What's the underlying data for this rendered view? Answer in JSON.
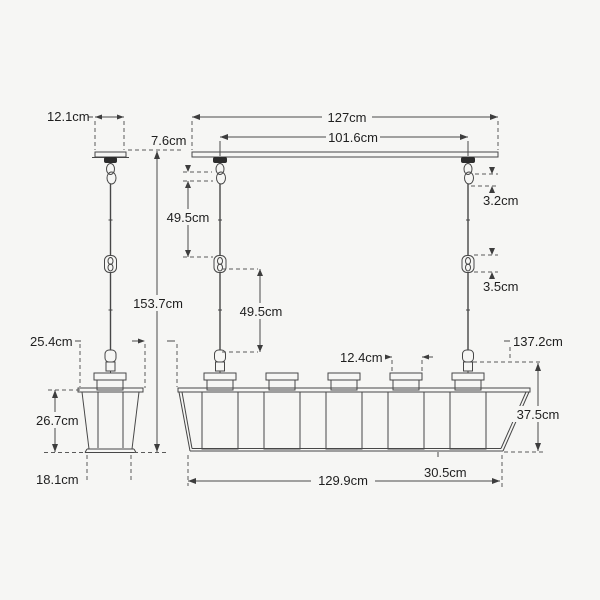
{
  "diagram": {
    "type": "technical-dimension-drawing",
    "subject": "linear lantern pendant light, end view and front view",
    "unit": "cm",
    "dims": {
      "canopy_width": "12.1cm",
      "canopy_detail": "7.6cm",
      "bar_length": "127cm",
      "suspension_spacing": "101.6cm",
      "hook_detail": "3.2cm",
      "upper_rod": "49.5cm",
      "lower_rod": "49.5cm",
      "coupler_detail": "3.5cm",
      "overall_height": "153.7cm",
      "shade_top_width": "25.4cm",
      "drop_to_body": "137.2cm",
      "cup_width": "12.4cm",
      "shade_height": "26.7cm",
      "body_height": "37.5cm",
      "shade_bottom_width": "18.1cm",
      "end_section": "30.5cm",
      "body_length": "129.9cm"
    }
  }
}
